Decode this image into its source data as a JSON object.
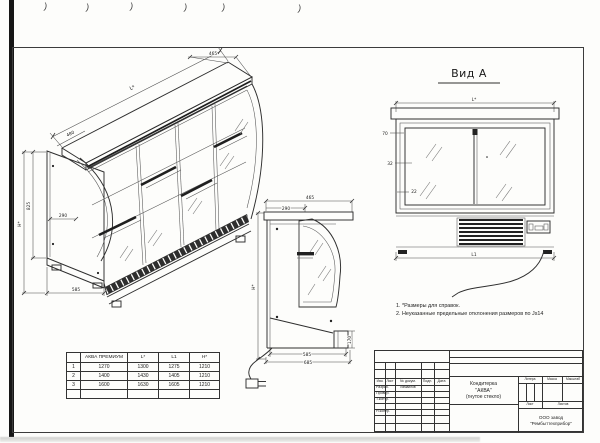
{
  "scan": {
    "mark_glyph": ")"
  },
  "views": {
    "isometric": {
      "dims": {
        "length": "L*",
        "top_width": "465",
        "canopy_depth": "480",
        "end_inset": "290",
        "depth": "585",
        "inner_height": "825",
        "overall_height": "H*"
      }
    },
    "side": {
      "dims": {
        "top_depth": "465",
        "top_flat": "290",
        "overall_height": "H*",
        "base_step_height": "170",
        "base_depth": "585",
        "overall_depth": "685"
      }
    },
    "front": {
      "label": "Вид А",
      "dims": {
        "top_length": "L*",
        "bottom_length": "L1"
      },
      "callouts": [
        "70",
        "32",
        "22"
      ]
    }
  },
  "notes": [
    "1. *Размеры для справок.",
    "2. Неуказанные предельные отклонения размеров по Js14"
  ],
  "table": {
    "headers": [
      "",
      "АКВА ПРЕМИУМ",
      "L*",
      "L1",
      "H*"
    ],
    "rows": [
      [
        "1",
        "1270",
        "1300",
        "1275",
        "1210"
      ],
      [
        "2",
        "1400",
        "1430",
        "1405",
        "1210"
      ],
      [
        "3",
        "1600",
        "1630",
        "1605",
        "1210"
      ],
      [
        "",
        "",
        "",
        "",
        ""
      ]
    ]
  },
  "title_block": {
    "revision_headers": [
      "Изм.",
      "Лист",
      "№ докум.",
      "Подп.",
      "Дата"
    ],
    "role_rows": [
      {
        "label": "Разраб.",
        "name": "Измаилов"
      },
      {
        "label": "Провер.",
        "name": ""
      },
      {
        "label": "Т.контр.",
        "name": ""
      },
      {
        "label": "Н.контр.",
        "name": ""
      }
    ],
    "doc_title": [
      "Кондитерка",
      "\"АКВА\"",
      "(гнутое стекло)"
    ],
    "right_headers": [
      "Литера",
      "Масса",
      "Масштаб"
    ],
    "sheet_labels": [
      "Лист",
      "Листов"
    ],
    "company": [
      "ООО завод",
      "\"Рембыттехприбор\""
    ]
  }
}
